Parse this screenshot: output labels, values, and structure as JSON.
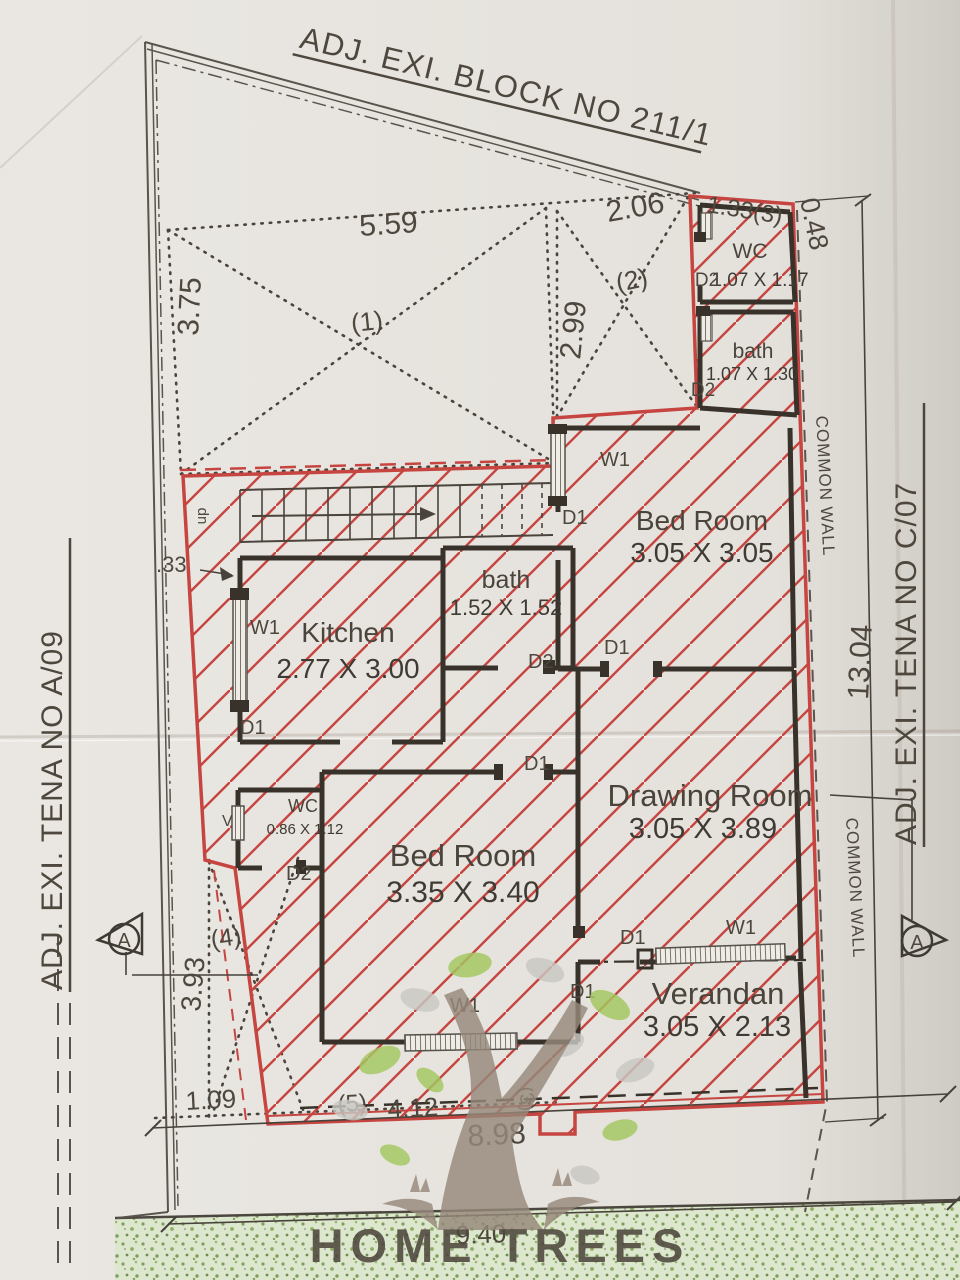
{
  "adjacent": {
    "top": "ADJ. EXI. BLOCK NO 211/1",
    "left": "ADJ. EXI. TENA NO A/09",
    "right": "ADJ. EXI. TENA NO C/07"
  },
  "rooms": [
    {
      "name": "WC",
      "dims": "1.07 X 1.17"
    },
    {
      "name": "bath",
      "dims": "1.07 X 1.30"
    },
    {
      "name": "Bed Room",
      "dims": "3.05 X 3.05"
    },
    {
      "name": "Kitchen",
      "dims": "2.77 X 3.00"
    },
    {
      "name": "bath",
      "dims": "1.52 X 1.52"
    },
    {
      "name": "WC",
      "dims": "0.86 X 1.12"
    },
    {
      "name": "Bed Room",
      "dims": "3.35 X 3.40"
    },
    {
      "name": "Drawing Room",
      "dims": "3.05 X 3.89"
    },
    {
      "name": "Verandan",
      "dims": "3.05 X 2.13"
    }
  ],
  "openings": {
    "w1": "W1",
    "d1": "D1",
    "d2": "D2",
    "v": "V",
    "up": "up"
  },
  "annotations": {
    "common_wall": "COMMON WALL",
    "section_a": "A"
  },
  "regions": {
    "r1": "(1)",
    "r2": "(2)",
    "r3": "(3)",
    "r4": "(4)",
    "r5": "(5)"
  },
  "dims": {
    "d5_59": "5.59",
    "d3_75": "3.75",
    "d2_06": "2.06",
    "d2_99": "2.99",
    "d1_33": "1.33(3)",
    "d0_48": "0.48",
    "d0_33": ".33",
    "d3_93": "3.93",
    "d1_09": "1.09",
    "d4_12": "4.12",
    "d8_98": "8.98",
    "d9_40": "9.40",
    "d13_04": "13.04"
  },
  "logo": {
    "text": "HOME TREES"
  },
  "colors": {
    "outline_red": "#c64540",
    "wall_black": "#38322b",
    "paper": "#e9e6e1",
    "green_band": "#dde7cd",
    "ink": "#4e473d"
  }
}
